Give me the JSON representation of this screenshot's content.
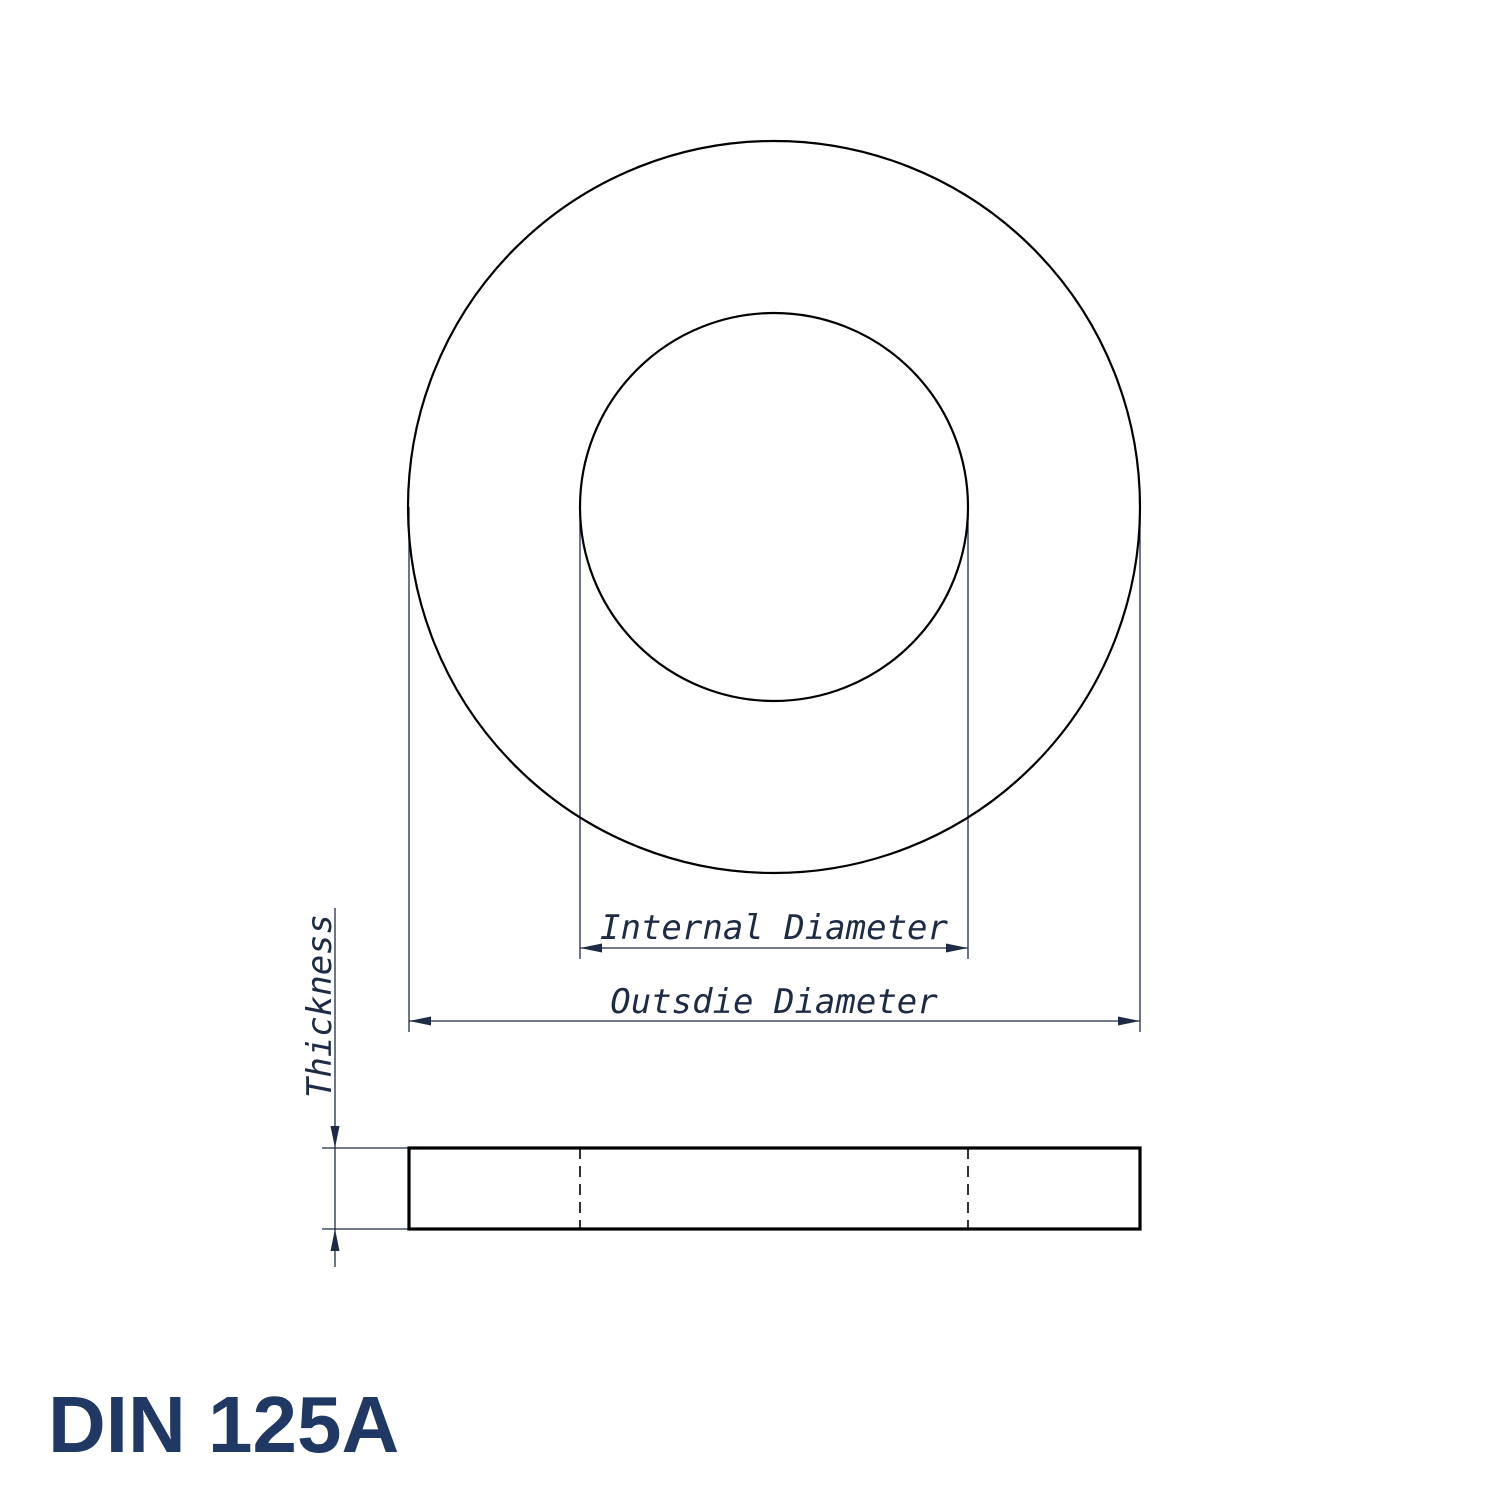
{
  "colors": {
    "background": "#ffffff",
    "outline": "#000000",
    "dimension": "#1d2c44",
    "title": "#1f3864"
  },
  "title": "DIN 125A",
  "labels": {
    "internal_diameter": "Internal Diameter",
    "outside_diameter": "Outsdie Diameter",
    "thickness": "Thickness"
  }
}
